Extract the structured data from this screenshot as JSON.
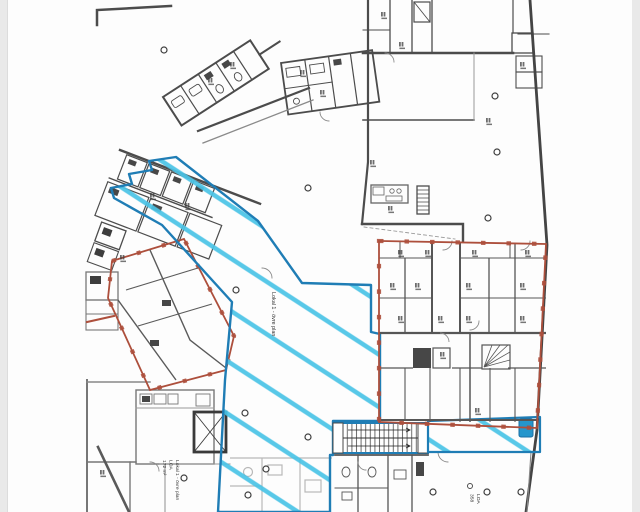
{
  "plan": {
    "labels": {
      "lokal1_area": "Lokal 1 - övre plan",
      "lokal1_info_line1": "Lokal 1 - övre plan",
      "lokal1_info_line2": "LOA",
      "lokal1_info_line3": "172 m²",
      "loa_right_line1": "LOA",
      "loa_right_line2": "358"
    },
    "colors": {
      "highlight_outline": "#1f7db5",
      "highlight_hatch": "#49c3e6",
      "boundary_red": "#ad4f3c",
      "wall_dark": "#4a4a4a",
      "wall_light": "#9a9a9a",
      "paper": "#fdfdfd",
      "margin": "#e9e9e9"
    }
  }
}
